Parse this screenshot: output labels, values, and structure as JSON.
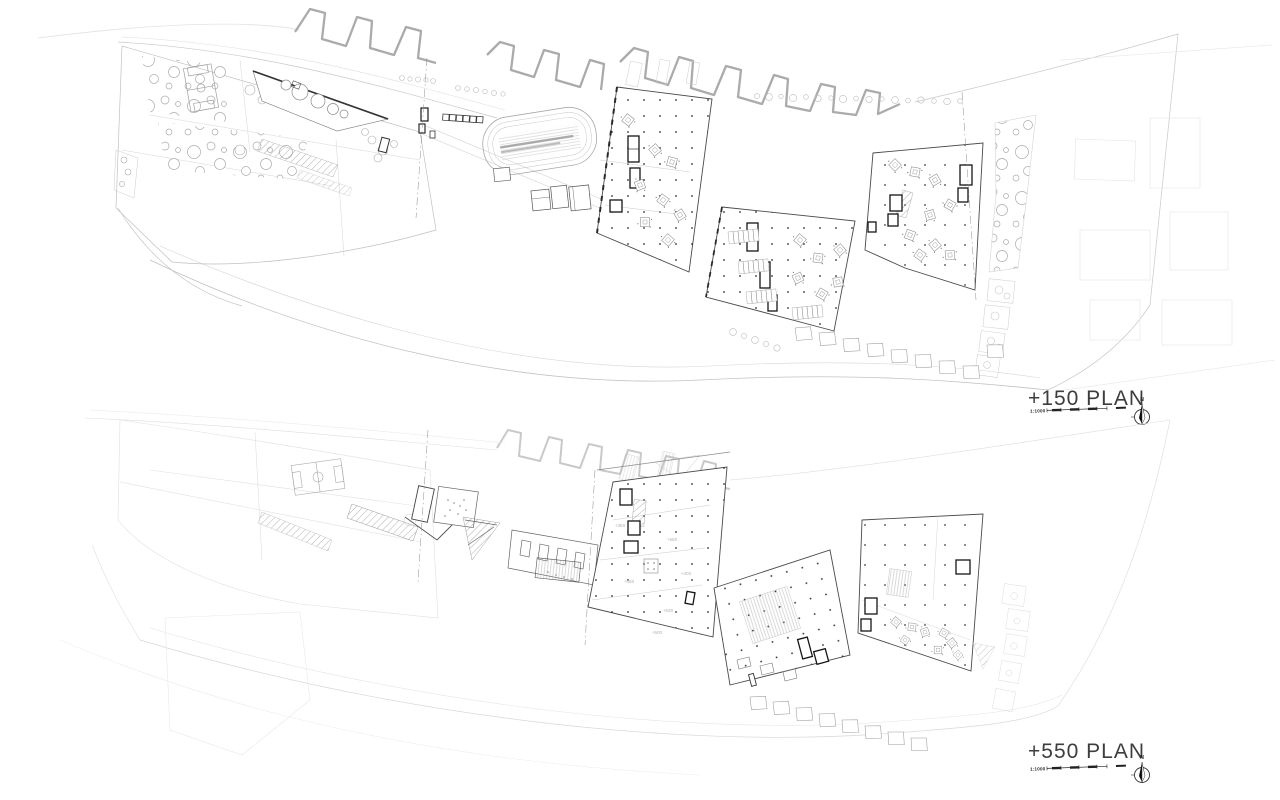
{
  "sheet": {
    "background": "#ffffff"
  },
  "plans": [
    {
      "id": "plan-150",
      "label": "+150 PLAN",
      "scale_label": "1:1000",
      "north_label": "N"
    },
    {
      "id": "plan-550",
      "label": "+550 PLAN",
      "scale_label": "1:1000",
      "north_label": "N",
      "level_annotations": [
        "+350",
        "+550",
        "+400",
        "+450",
        "+630",
        "+500"
      ]
    }
  ],
  "colors": {
    "ink_dark": "#1a1a1a",
    "building_outline": "#4a4a4a",
    "line_mid": "#9a9a9a",
    "line_light": "#c8c8c8",
    "line_faint": "#e2e2e2",
    "column_dot": "#2b2b2b"
  }
}
